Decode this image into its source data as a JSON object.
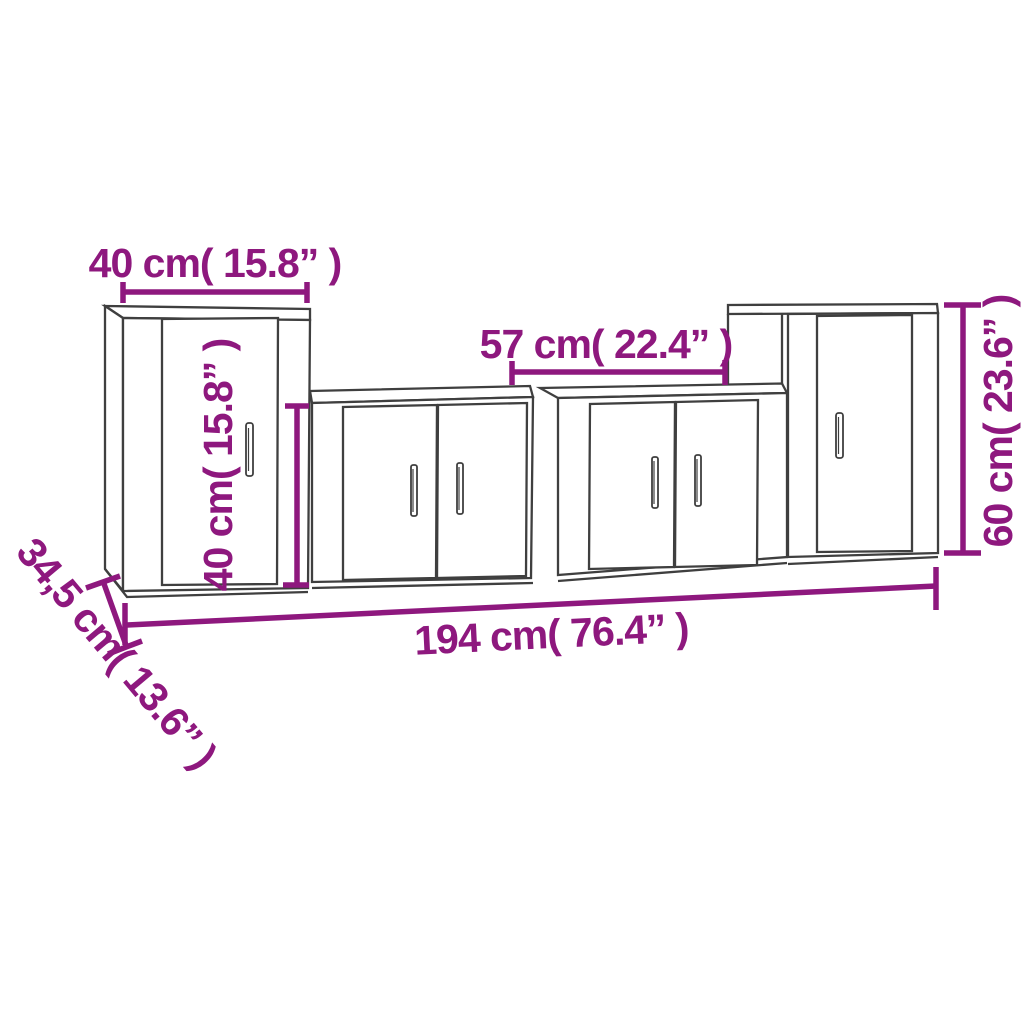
{
  "canvas": {
    "width": 1024,
    "height": 1024
  },
  "colors": {
    "dimension_accent": "#8E187E",
    "furniture_outline": "#3F3F3F",
    "background": "#FFFFFF"
  },
  "diagram_type": "furniture-dimension-diagram",
  "dimensions": {
    "cabinet_left_width": {
      "label": "40 cm( 15.8” )",
      "value_cm": "40",
      "value_inch": "15.8"
    },
    "cabinet_low_width": {
      "label": "57 cm( 22.4” )",
      "value_cm": "57",
      "value_inch": "22.4"
    },
    "cabinet_left_height": {
      "label": "40 cm( 15.8” )",
      "value_cm": "40",
      "value_inch": "15.8"
    },
    "cabinet_right_height": {
      "label": "60 cm( 23.6” )",
      "value_cm": "60",
      "value_inch": "23.6"
    },
    "total_width": {
      "label": "194 cm( 76.4” )",
      "value_cm": "194",
      "value_inch": "76.4"
    },
    "depth": {
      "label": "34,5 cm( 13.6” )",
      "value_cm": "34,5",
      "value_inch": "13.6"
    }
  }
}
